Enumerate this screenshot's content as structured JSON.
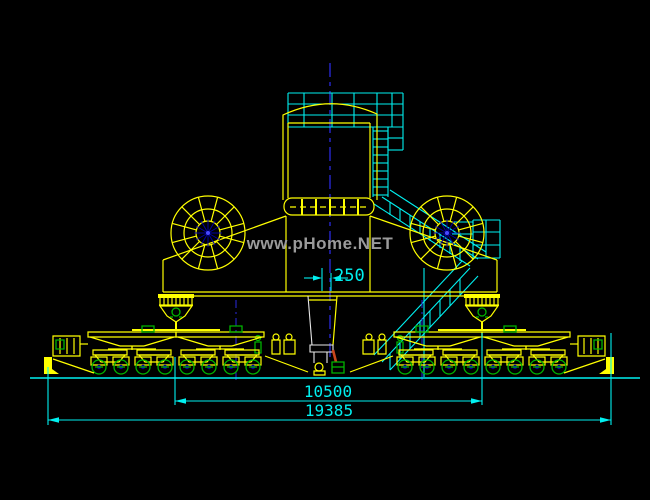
{
  "canvas": {
    "background": "#000000",
    "width": 650,
    "height": 500
  },
  "watermark": {
    "text": "www.pHome.NET",
    "color": "#9B9B9B"
  },
  "dimension_labels": {
    "center_offset": "250",
    "bogie_span": "10500",
    "overall_span": "19385"
  },
  "palette": {
    "yellow": "#FFFF00",
    "cyan": "#00F0F0",
    "green": "#00B400",
    "blue": "#2A2ADF",
    "hubblue": "#0000A0",
    "hubbright": "#4848FF",
    "white": "#E8E8E8",
    "red": "#C8461E",
    "gray": "#9B9B9B"
  },
  "icons": {
    "drum_wheel": "spoked-wheel-icon",
    "bogie_wheel": "rail-wheel-icon"
  }
}
